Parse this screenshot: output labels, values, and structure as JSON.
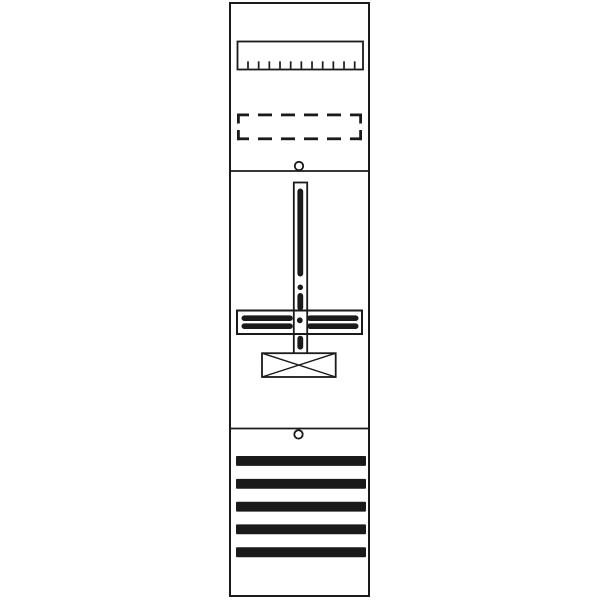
{
  "canvas": {
    "width": 600,
    "height": 600,
    "background": "#ffffff",
    "ink": "#1a1a1a"
  },
  "diagram": {
    "name": "meter-panel-layout",
    "shapes": [
      {
        "name": "panel-outline",
        "type": "rect",
        "x": 230,
        "y": 3,
        "w": 139,
        "h": 593,
        "sw": 2,
        "fill": "bg"
      },
      {
        "name": "top-section-divider",
        "type": "line",
        "x1": 230,
        "y1": 171,
        "x2": 369,
        "y2": 171,
        "sw": 1.8
      },
      {
        "name": "bottom-section-divider",
        "type": "line",
        "x1": 230,
        "y1": 428.5,
        "x2": 369,
        "y2": 428.5,
        "sw": 1.8
      },
      {
        "name": "terminal-strip-body",
        "type": "rect",
        "x": 237.5,
        "y": 41.5,
        "w": 125.5,
        "h": 28,
        "sw": 1.8,
        "fill": "none"
      },
      {
        "name": "terminal-strip-teeth",
        "type": "ticks",
        "x0": 248,
        "dx": 10.67,
        "count": 11,
        "y1": 61.3,
        "y2": 68.6,
        "sw": 1.7
      },
      {
        "name": "reserved-slot-dashed",
        "type": "dashes",
        "sw": 2.8,
        "segments": [
          [
            237,
            114.9,
            249,
            114.9
          ],
          [
            258,
            114.9,
            272,
            114.9
          ],
          [
            281,
            114.9,
            295,
            114.9
          ],
          [
            304,
            114.9,
            318,
            114.9
          ],
          [
            327,
            114.9,
            341,
            114.9
          ],
          [
            350,
            114.9,
            362,
            114.9
          ],
          [
            237,
            138.8,
            249,
            138.8
          ],
          [
            258,
            138.8,
            272,
            138.8
          ],
          [
            281,
            138.8,
            295,
            138.8
          ],
          [
            304,
            138.8,
            318,
            138.8
          ],
          [
            327,
            138.8,
            341,
            138.8
          ],
          [
            350,
            138.8,
            362,
            138.8
          ],
          [
            238.4,
            113.5,
            238.4,
            123.5
          ],
          [
            238.4,
            130,
            238.4,
            140.2
          ],
          [
            360.6,
            113.5,
            360.6,
            123.5
          ],
          [
            360.6,
            130,
            360.6,
            140.2
          ]
        ]
      },
      {
        "name": "top-screw-hole",
        "type": "circle",
        "cx": 299,
        "cy": 166,
        "r": 4.2,
        "sw": 1.8,
        "fill": "bg"
      },
      {
        "name": "busbar-crossbar-outline",
        "type": "rect",
        "x": 237,
        "y": 310.5,
        "w": 125,
        "h": 23.5,
        "sw": 2,
        "fill": "bg"
      },
      {
        "name": "mounting-rail-outline",
        "type": "rect",
        "x": 293.8,
        "y": 182.5,
        "w": 13.4,
        "h": 171.5,
        "sw": 1.8,
        "fill": "none"
      },
      {
        "name": "connection-box-outline",
        "type": "rect",
        "x": 262,
        "y": 353.2,
        "w": 73.7,
        "h": 23.8,
        "sw": 1.8,
        "fill": "bg"
      },
      {
        "name": "connection-box-diagonal-1",
        "type": "line",
        "x1": 262,
        "y1": 353.2,
        "x2": 335.7,
        "y2": 377,
        "sw": 1.4
      },
      {
        "name": "connection-box-diagonal-2",
        "type": "line",
        "x1": 262,
        "y1": 377,
        "x2": 335.7,
        "y2": 353.2,
        "sw": 1.4
      },
      {
        "name": "rail-slot-upper",
        "type": "frect",
        "x": 297.4,
        "y": 188.5,
        "w": 5.8,
        "h": 88,
        "rx": 2.9
      },
      {
        "name": "rail-slot-dot",
        "type": "fcircle",
        "cx": 300.3,
        "cy": 287.3,
        "r": 2.8
      },
      {
        "name": "rail-slot-middle",
        "type": "frect",
        "x": 297.4,
        "y": 293,
        "w": 5.8,
        "h": 17.5,
        "rx": 2.9
      },
      {
        "name": "rail-slot-lower",
        "type": "frect",
        "x": 297.4,
        "y": 335.8,
        "w": 5.8,
        "h": 13.8,
        "rx": 2.9
      },
      {
        "name": "crossbar-bar-left-top",
        "type": "frect",
        "x": 241.5,
        "y": 315.4,
        "w": 51.3,
        "h": 5.6,
        "rx": 2.8
      },
      {
        "name": "crossbar-bar-left-bottom",
        "type": "frect",
        "x": 241.5,
        "y": 323.4,
        "w": 51.3,
        "h": 5.6,
        "rx": 2.8
      },
      {
        "name": "crossbar-bar-right-top",
        "type": "frect",
        "x": 307.2,
        "y": 315.4,
        "w": 51.3,
        "h": 5.6,
        "rx": 2.8
      },
      {
        "name": "crossbar-bar-right-bottom",
        "type": "frect",
        "x": 307.2,
        "y": 323.4,
        "w": 51.3,
        "h": 5.6,
        "rx": 2.8
      },
      {
        "name": "crossbar-center-dot",
        "type": "fcircle",
        "cx": 299.8,
        "cy": 320.3,
        "r": 2.9
      },
      {
        "name": "bottom-screw-hole",
        "type": "circle",
        "cx": 298.5,
        "cy": 434.4,
        "r": 4.2,
        "sw": 1.8,
        "fill": "bg"
      },
      {
        "name": "cover-bar-1",
        "type": "frect",
        "x": 236,
        "y": 456,
        "w": 130,
        "h": 9.9,
        "rx": 1
      },
      {
        "name": "cover-bar-2",
        "type": "frect",
        "x": 236,
        "y": 478.9,
        "w": 130,
        "h": 9.9,
        "rx": 1
      },
      {
        "name": "cover-bar-3",
        "type": "frect",
        "x": 236,
        "y": 501.7,
        "w": 130,
        "h": 9.9,
        "rx": 1
      },
      {
        "name": "cover-bar-4",
        "type": "frect",
        "x": 236,
        "y": 524.4,
        "w": 130,
        "h": 9.9,
        "rx": 1
      },
      {
        "name": "cover-bar-5",
        "type": "frect",
        "x": 236,
        "y": 547.3,
        "w": 130,
        "h": 9.9,
        "rx": 1
      }
    ]
  }
}
